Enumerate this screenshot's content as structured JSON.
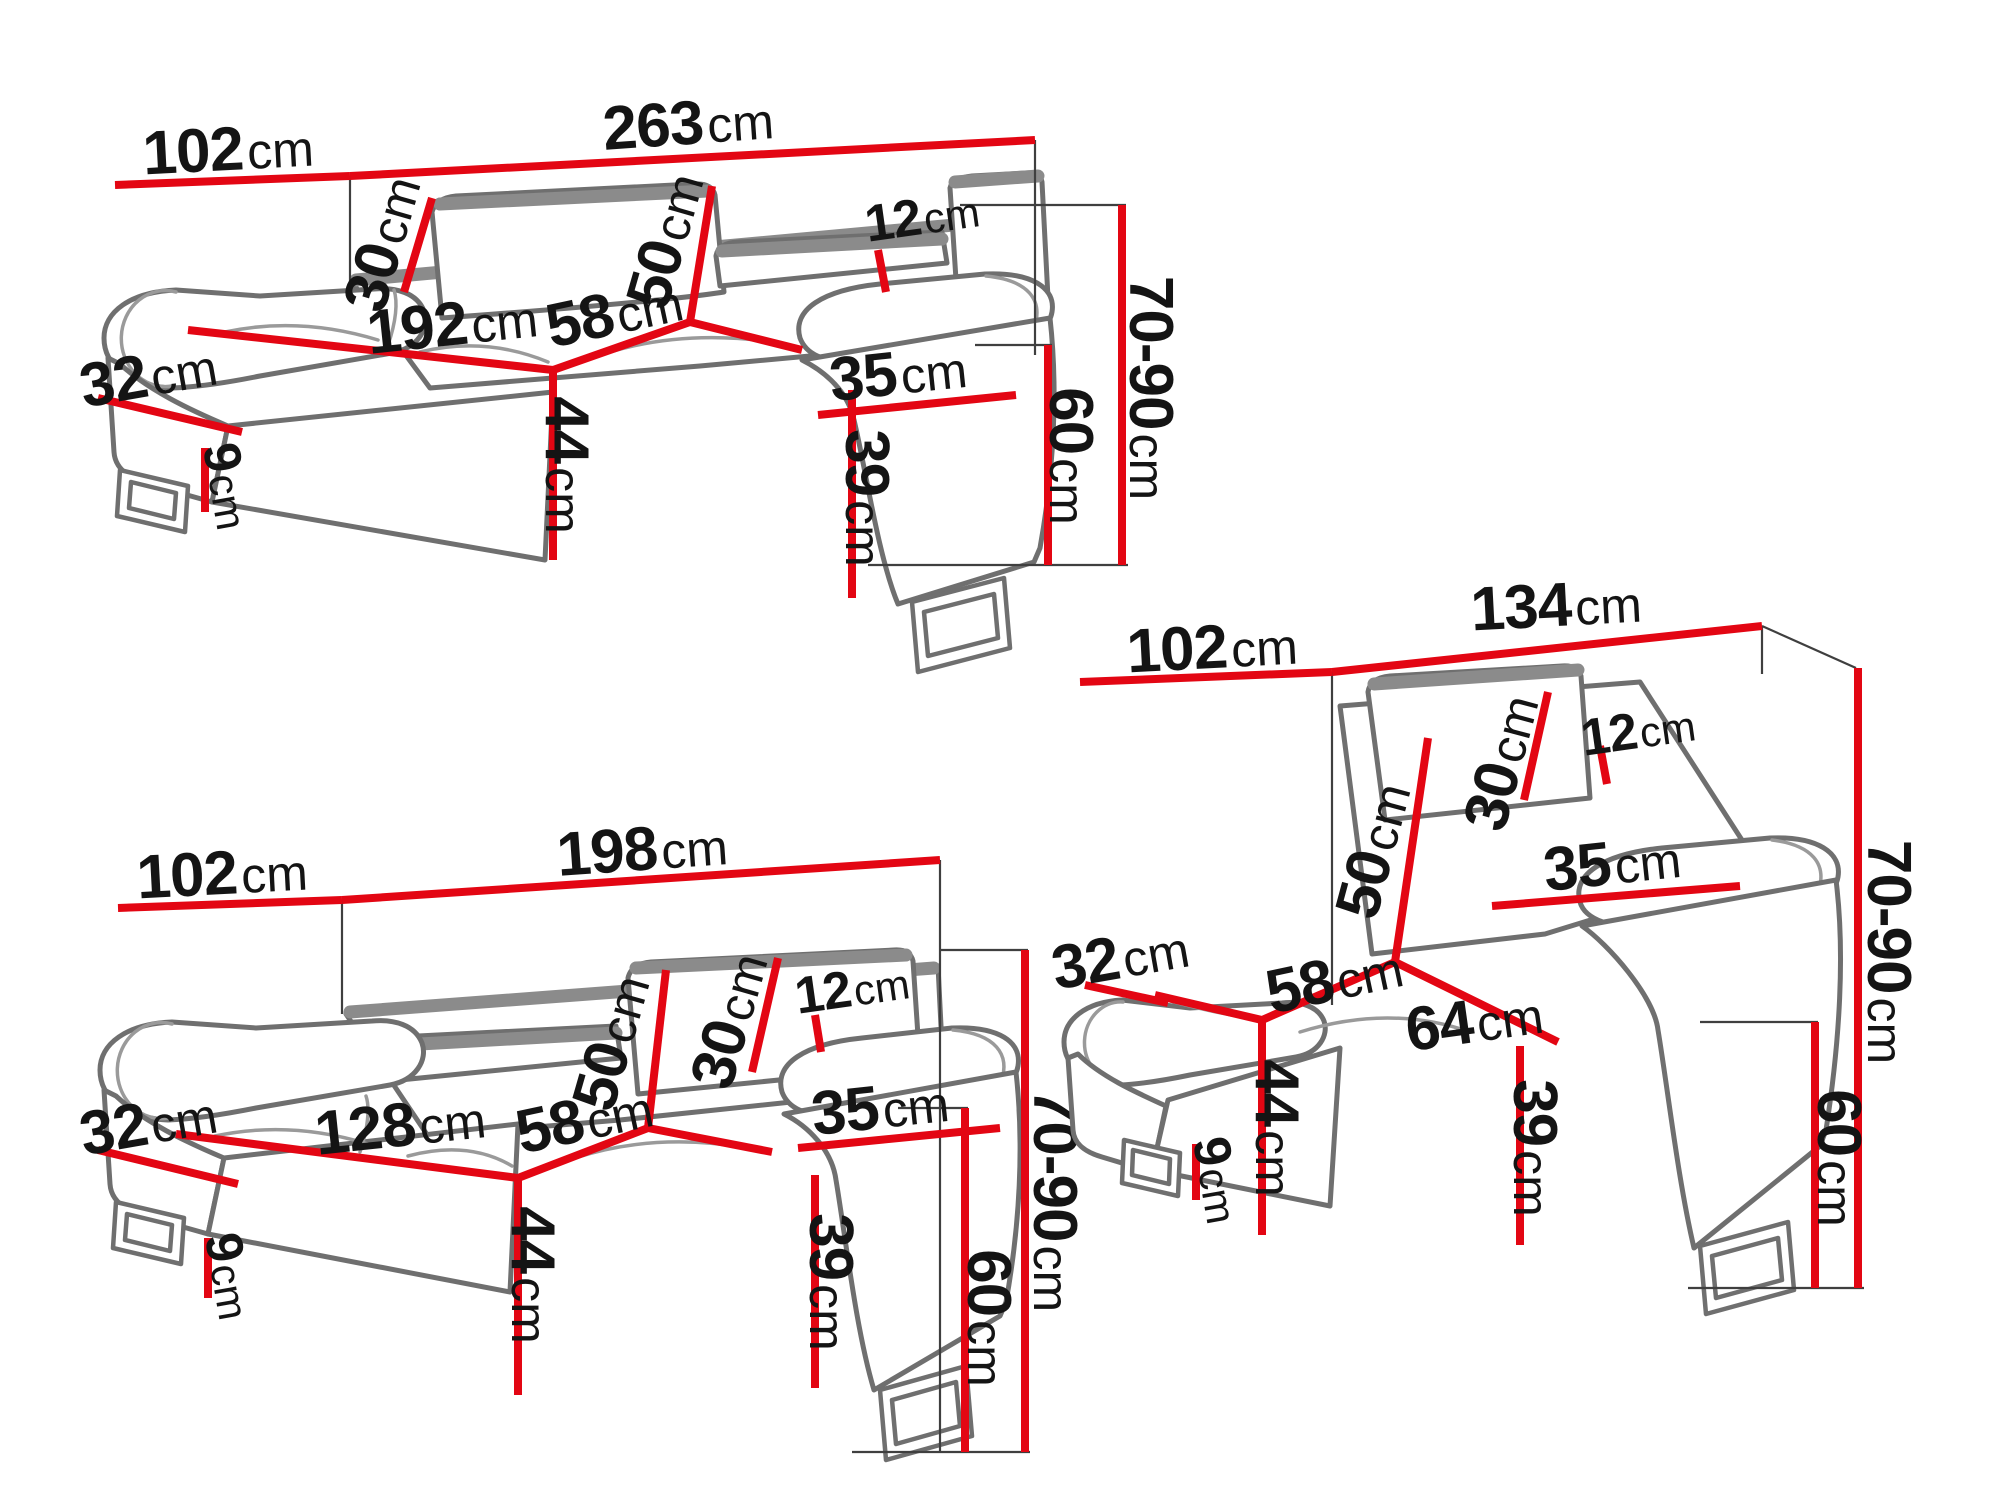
{
  "diagram": "sofa-set-dimension-drawing",
  "colors": {
    "dimension_line": "#e30613",
    "outline": "#6f6f6f",
    "label": "#141414"
  },
  "sofas": [
    {
      "id": "three-seater-sofa",
      "dims": {
        "depth": {
          "value": "102",
          "unit": "cm"
        },
        "width": {
          "value": "263",
          "unit": "cm"
        },
        "headrest_width": {
          "value": "30",
          "unit": "cm"
        },
        "backrest_height": {
          "value": "50",
          "unit": "cm"
        },
        "headrest_thickness": {
          "value": "12",
          "unit": "cm"
        },
        "seat_width": {
          "value": "192",
          "unit": "cm"
        },
        "seat_depth": {
          "value": "58",
          "unit": "cm"
        },
        "armrest_width": {
          "value": "35",
          "unit": "cm"
        },
        "armrest_front": {
          "value": "32",
          "unit": "cm"
        },
        "seat_height": {
          "value": "44",
          "unit": "cm"
        },
        "leg_height": {
          "value": "9",
          "unit": "cm"
        },
        "armrest_height": {
          "value": "39",
          "unit": "cm"
        },
        "armrest_total": {
          "value": "60",
          "unit": "cm"
        },
        "total_height": {
          "value": "70-90",
          "unit": "cm"
        }
      }
    },
    {
      "id": "two-seater-sofa",
      "dims": {
        "depth": {
          "value": "102",
          "unit": "cm"
        },
        "width": {
          "value": "198",
          "unit": "cm"
        },
        "headrest_width": {
          "value": "30",
          "unit": "cm"
        },
        "backrest_height": {
          "value": "50",
          "unit": "cm"
        },
        "headrest_thickness": {
          "value": "12",
          "unit": "cm"
        },
        "seat_width": {
          "value": "128",
          "unit": "cm"
        },
        "seat_depth": {
          "value": "58",
          "unit": "cm"
        },
        "armrest_width": {
          "value": "35",
          "unit": "cm"
        },
        "armrest_front": {
          "value": "32",
          "unit": "cm"
        },
        "seat_height": {
          "value": "44",
          "unit": "cm"
        },
        "leg_height": {
          "value": "9",
          "unit": "cm"
        },
        "armrest_height": {
          "value": "39",
          "unit": "cm"
        },
        "armrest_total": {
          "value": "60",
          "unit": "cm"
        },
        "total_height": {
          "value": "70-90",
          "unit": "cm"
        }
      }
    },
    {
      "id": "armchair",
      "dims": {
        "depth": {
          "value": "102",
          "unit": "cm"
        },
        "width": {
          "value": "134",
          "unit": "cm"
        },
        "headrest_width": {
          "value": "30",
          "unit": "cm"
        },
        "backrest_height": {
          "value": "50",
          "unit": "cm"
        },
        "headrest_thickness": {
          "value": "12",
          "unit": "cm"
        },
        "seat_width": {
          "value": "64",
          "unit": "cm"
        },
        "seat_depth": {
          "value": "58",
          "unit": "cm"
        },
        "armrest_width": {
          "value": "35",
          "unit": "cm"
        },
        "armrest_front": {
          "value": "32",
          "unit": "cm"
        },
        "seat_height": {
          "value": "44",
          "unit": "cm"
        },
        "leg_height": {
          "value": "9",
          "unit": "cm"
        },
        "armrest_height": {
          "value": "39",
          "unit": "cm"
        },
        "armrest_total": {
          "value": "60",
          "unit": "cm"
        },
        "total_height": {
          "value": "70-90",
          "unit": "cm"
        }
      }
    }
  ]
}
